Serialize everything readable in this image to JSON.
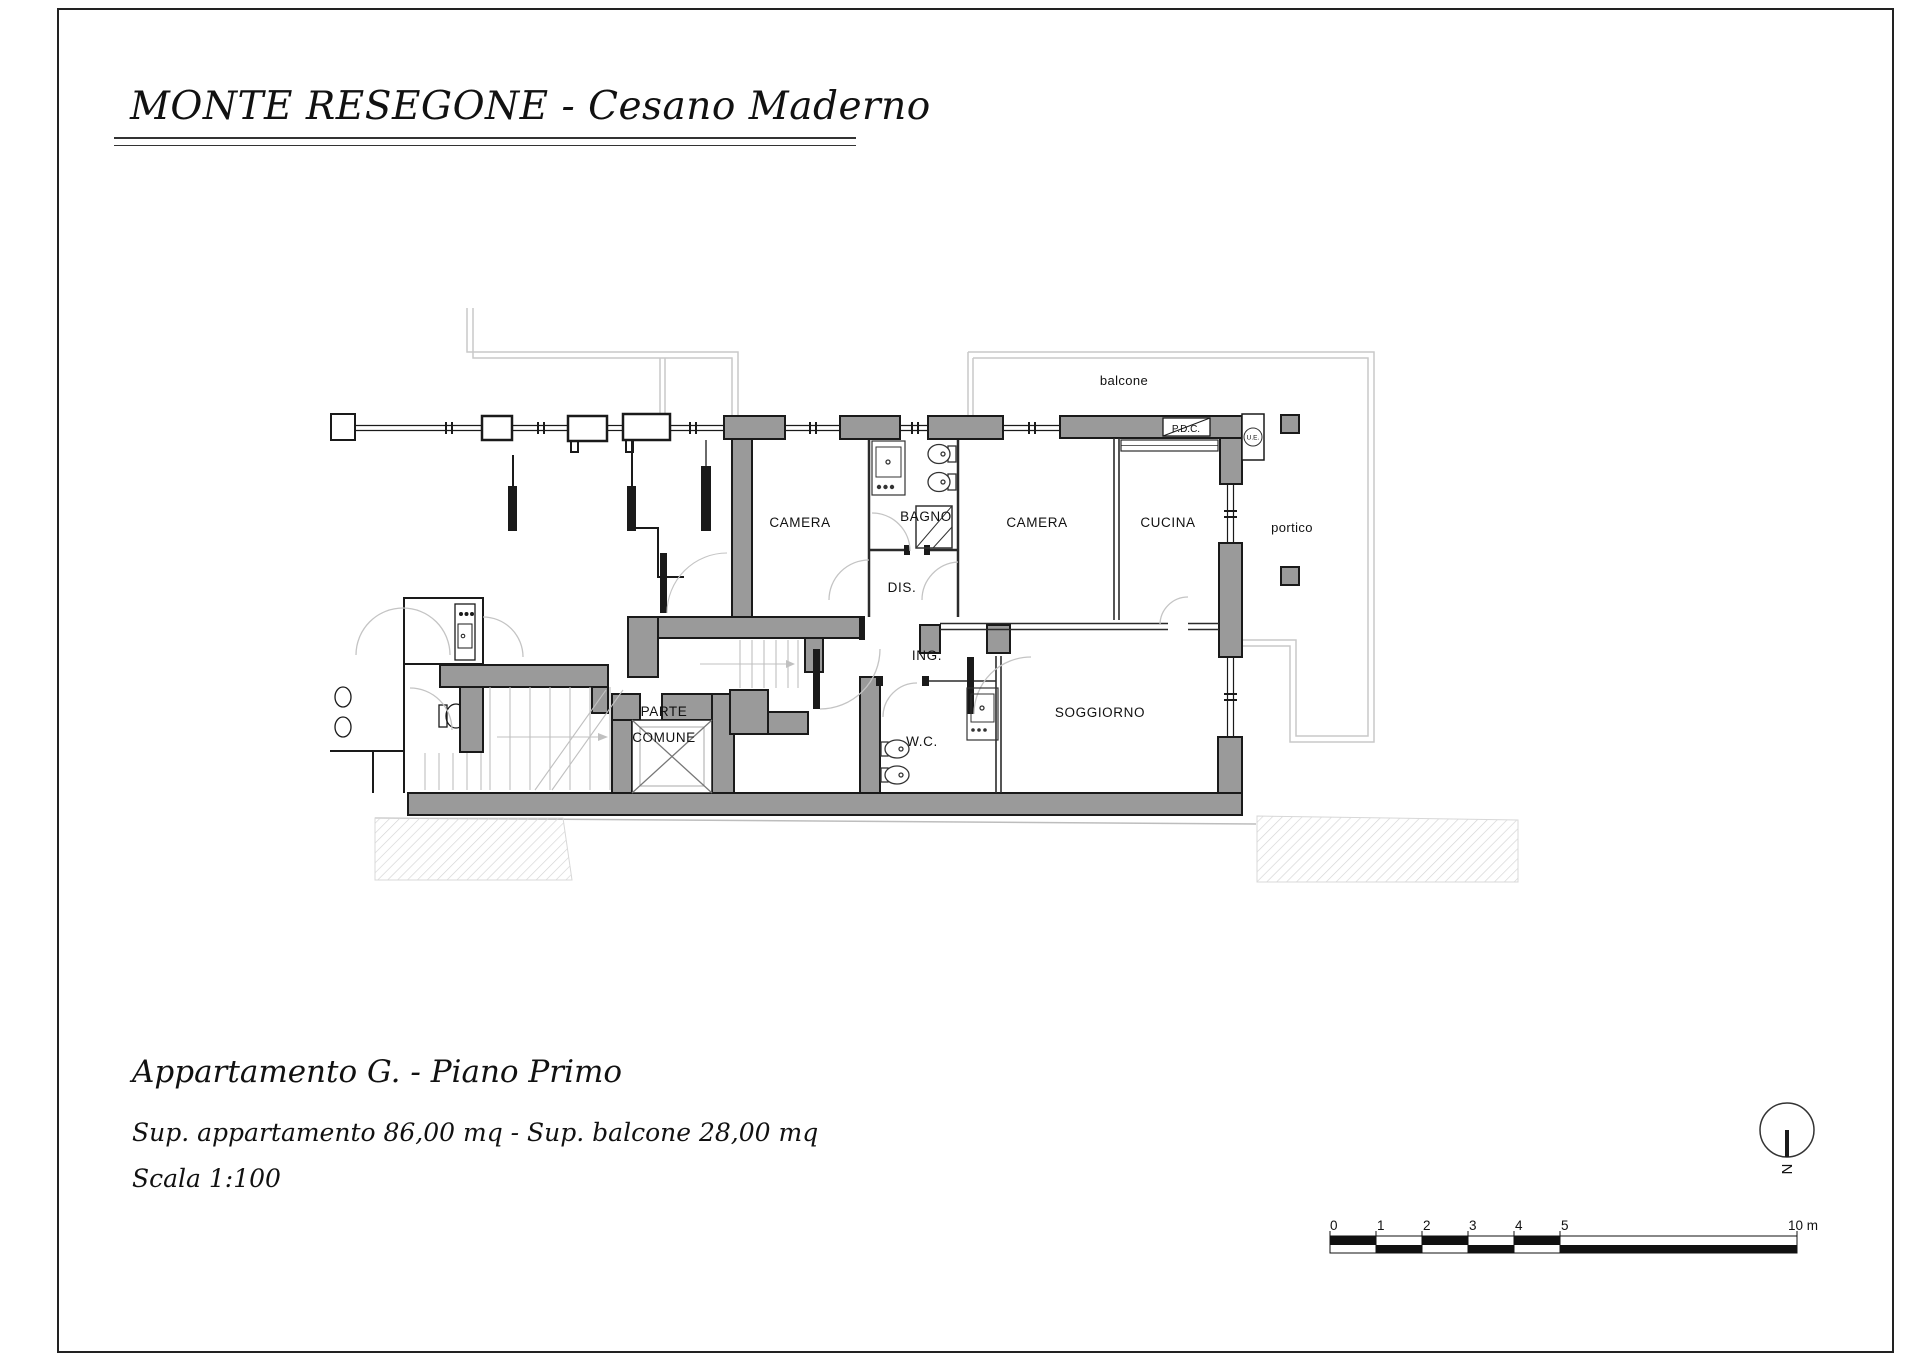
{
  "page": {
    "title": "MONTE RESEGONE - Cesano Maderno",
    "footer": {
      "apartment": "Appartamento G. - Piano Primo",
      "surfaces": "Sup. appartamento 86,00 mq - Sup. balcone 28,00 mq",
      "scale": "Scala 1:100"
    }
  },
  "plan": {
    "rooms": {
      "camera_left": "CAMERA",
      "bagno": "BAGNO",
      "camera_right": "CAMERA",
      "cucina": "CUCINA",
      "disimpegno": "DIS.",
      "ingresso": "ING.",
      "wc": "W.C.",
      "soggiorno": "SOGGIORNO",
      "parte_comune_1": "PARTE",
      "parte_comune_2": "COMUNE"
    },
    "outdoor": {
      "balcone": "balcone",
      "portico": "portico"
    },
    "annotations": {
      "pdc": "P.D.C.",
      "ue": "U.E."
    },
    "colors": {
      "wall_fill": "#9a9a9a",
      "wall_outline": "#1a1a1a",
      "thin_outline": "#c9c9c9",
      "paper": "#ffffff"
    }
  },
  "scalebar": {
    "labels": [
      "0",
      "1",
      "2",
      "3",
      "4",
      "5"
    ],
    "end_label": "10 m"
  },
  "north_indicator": {
    "label": "N"
  }
}
